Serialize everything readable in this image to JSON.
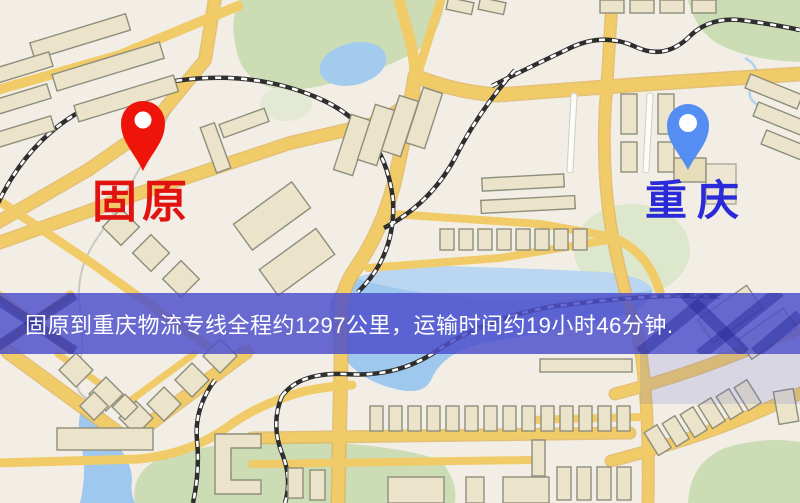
{
  "map": {
    "markers": {
      "origin": {
        "label": "固原",
        "icon": "map-pin-icon",
        "pin_color": "#ee1409",
        "label_color": "#e01310"
      },
      "destination": {
        "label": "重庆",
        "icon": "map-pin-icon",
        "pin_color": "#548ef2",
        "label_color": "#2a2ad8"
      }
    },
    "palette": {
      "background": "#f2eee6",
      "road_yellow": "#f0cb67",
      "road_casing": "#e0b255",
      "building_fill": "#ebe3ca",
      "building_stroke": "#8e8e7c",
      "green_area": "#ccdcb4",
      "water": "#9fc8ee",
      "railway": "#2e2e2e"
    }
  },
  "banner": {
    "text": "固原到重庆物流专线全程约1297公里，运输时间约19小时46分钟.",
    "background_color": "#4e50cc",
    "text_color": "#ffffff"
  }
}
